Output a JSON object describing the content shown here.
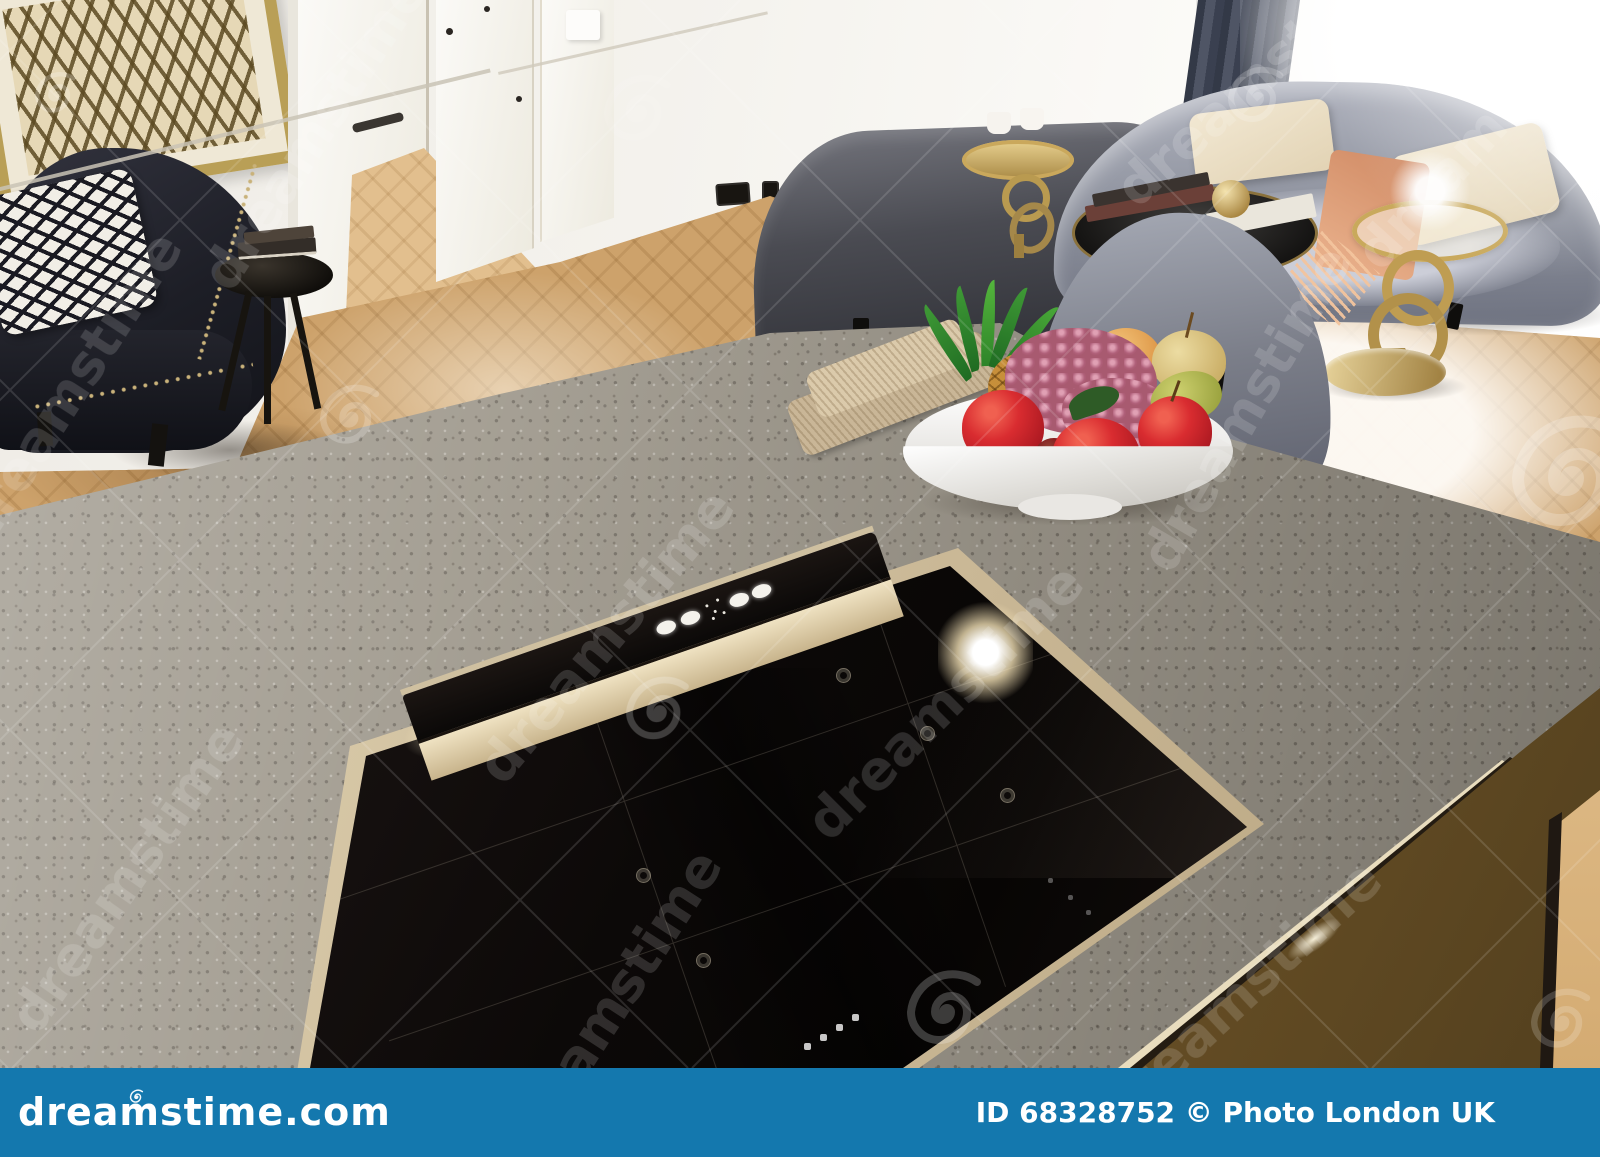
{
  "footer": {
    "brand": "dreamstime.com",
    "credit": "ID 68328752 © Photo London UK",
    "bar_color": "#1478ae"
  },
  "watermark": {
    "word": "dreamstime",
    "logo": "spiral-icon"
  },
  "colors": {
    "countertop_quartz": "#a09a8e",
    "hob_glass": "#0c0908",
    "hob_trim_metal": "#d8c9a7",
    "floor_oak": "#cda26b",
    "wall": "#f3f1ec",
    "gold_accent": "#c2a156",
    "sofa_velvet_grey": "#8e929e",
    "armchair_navy": "#23242c",
    "apple_red": "#c2242c",
    "bowl_white": "#f5f4f1",
    "cabinet_bronze": "#7a5c2c"
  },
  "scene": {
    "objects": [
      "framed-artwork",
      "hallway-doors",
      "wingback-armchair",
      "greek-key-pillow",
      "black-side-table",
      "grey-velvet-sofa",
      "tub-chair",
      "curved-velvet-sofa",
      "cream-cushions",
      "peach-throw",
      "glass-coffee-table",
      "gold-ring-side-table",
      "gold-accent-table",
      "dark-curtain",
      "herringbone-floor",
      "quartz-countertop",
      "induction-hob",
      "hob-control-strip",
      "fruit-bowl",
      "placemats"
    ]
  }
}
